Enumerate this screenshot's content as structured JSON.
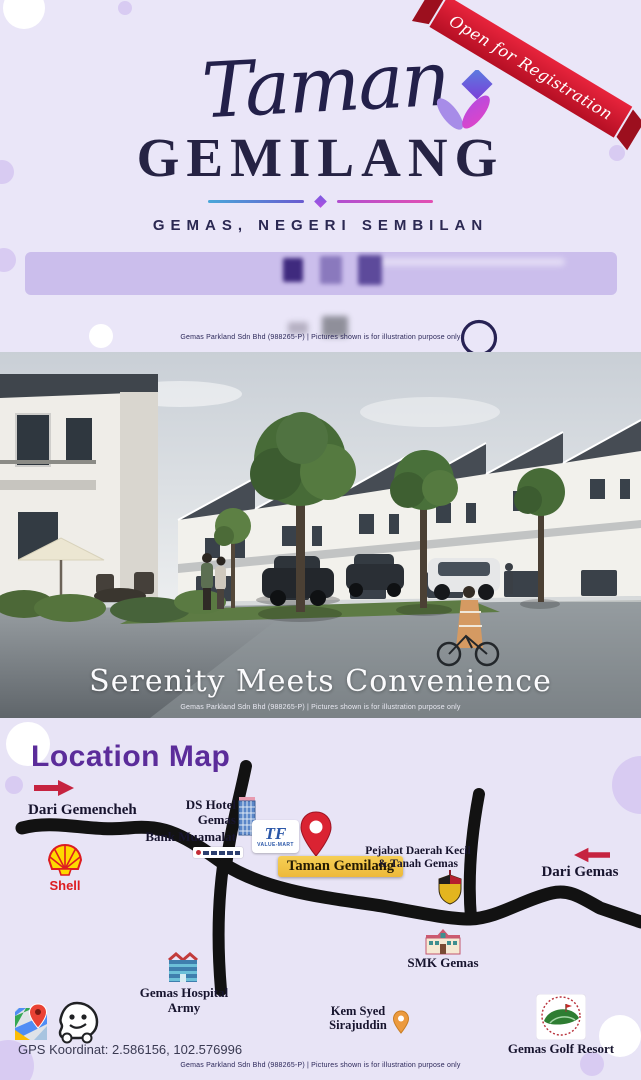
{
  "hero": {
    "ribbon_label": "Open for Registration",
    "title_script": "Taman",
    "title_main": "GEMILANG",
    "subtitle": "GEMAS, NEGERI SEMBILAN",
    "disclaimer": "Gemas Parkland Sdn Bhd (988265-P)   |   Pictures shown is for illustration purpose only"
  },
  "showcase": {
    "tagline": "Serenity Meets Convenience",
    "disclaimer": "Gemas Parkland Sdn Bhd (988265-P)   |   Pictures shown is for illustration purpose only"
  },
  "location": {
    "title": "Location Map",
    "from_west": "Dari Gemencheh",
    "from_east": "Dari Gemas",
    "shell_label": "Shell",
    "ds_hotel_line1": "DS Hotel",
    "ds_hotel_line2": "Gemas",
    "bank_label": "Bank Muamalat",
    "tf_initials": "TF",
    "tf_sub": "VALUE-MART",
    "project_label": "Taman Gemilang",
    "pejabat_line1": "Pejabat Daerah Kecil",
    "pejabat_line2": "& Tanah Gemas",
    "smk_label": "SMK Gemas",
    "hospital_line1": "Gemas Hospital",
    "hospital_line2": "Army",
    "kem_line1": "Kem Syed",
    "kem_line2": "Sirajuddin",
    "golf_label": "Gemas Golf Resort",
    "gps_label": "GPS Koordinat: 2.586156, 102.576996",
    "disclaimer": "Gemas Parkland Sdn Bhd (988265-P)   |   Pictures shown is for illustration purpose only"
  },
  "colors": {
    "background_lavender": "#eae6f8",
    "ribbon_red": "#d41f33",
    "title_navy": "#262344",
    "map_title_purple": "#5b2c9a",
    "road_black": "#121212",
    "project_highlight": "#f3c043",
    "arrow_red": "#c62340",
    "shell_yellow": "#fed900",
    "shell_red": "#dd1d21"
  },
  "icons": [
    "ribbon-banner",
    "flower-logo",
    "ring-doodle",
    "arrow-right-icon",
    "arrow-left-icon",
    "shell-logo",
    "hotel-building-icon",
    "bank-muamalat-logo",
    "tf-value-mart-logo",
    "red-map-pin-icon",
    "state-crest-icon",
    "school-icon",
    "hospital-icon",
    "orange-map-pin-icon",
    "golf-resort-logo",
    "google-maps-icon",
    "waze-icon"
  ]
}
